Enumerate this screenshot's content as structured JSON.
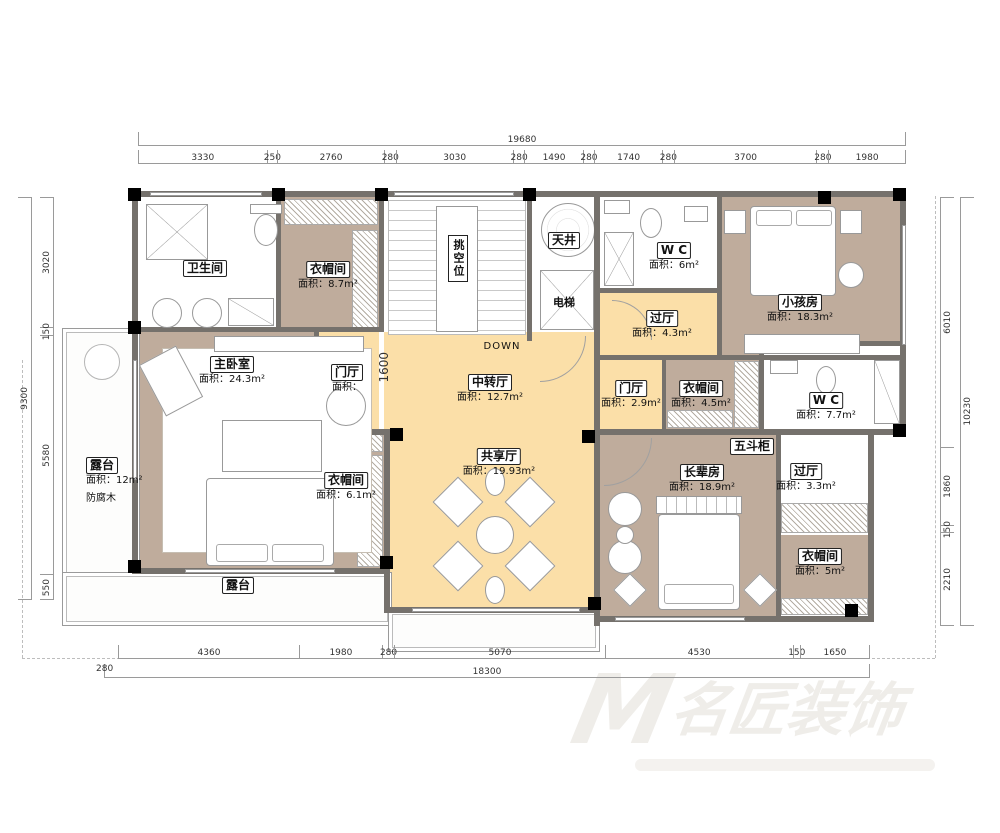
{
  "watermark": {
    "logo": "M",
    "text": "名匠装饰"
  },
  "colors": {
    "hall": "#FBDFA8",
    "room_taupe": "#BFAC9C",
    "wall": "#75716C",
    "column": "#000000"
  },
  "dimensions": {
    "top": {
      "total": "19680",
      "segments": [
        "3330",
        "250",
        "2760",
        "280",
        "3030",
        "280",
        "1490",
        "280",
        "1740",
        "280",
        "3700",
        "280",
        "1980"
      ]
    },
    "bottom": {
      "total": "18300",
      "lead": "280",
      "segments": [
        "4360",
        "1980",
        "280",
        "5070",
        "4530",
        "150",
        "1650"
      ]
    },
    "left": {
      "total": "9300",
      "segments": [
        "3020",
        "150",
        "5580",
        "550"
      ]
    },
    "right": {
      "total": "10230",
      "segments": [
        "6010",
        "1860",
        "150",
        "2210"
      ]
    }
  },
  "rooms": [
    {
      "name": "卫生间",
      "area": ""
    },
    {
      "name": "衣帽间",
      "area": "面积：8.7m²"
    },
    {
      "name": "W C",
      "area": "面积：6m²"
    },
    {
      "name": "过厅",
      "area": "面积：4.3m²"
    },
    {
      "name": "小孩房",
      "area": "面积：18.3m²"
    },
    {
      "name": "主卧室",
      "area": "面积：24.3m²"
    },
    {
      "name": "门厅",
      "area": "面积："
    },
    {
      "name": "中转厅",
      "area": "面积：12.7m²"
    },
    {
      "name": "门厅",
      "area": "面积：2.9m²"
    },
    {
      "name": "衣帽间",
      "area": "面积：4.5m²"
    },
    {
      "name": "W C",
      "area": "面积：7.7m²"
    },
    {
      "name": "露台",
      "area": "面积：12m²",
      "note": "防腐木"
    },
    {
      "name": "衣帽间",
      "area": "面积：6.1m²"
    },
    {
      "name": "共享厅",
      "area": "面积：19.93m²"
    },
    {
      "name": "长辈房",
      "area": "面积：18.9m²"
    },
    {
      "name": "过厅",
      "area": "面积：3.3m²"
    },
    {
      "name": "衣帽间",
      "area": "面积：5m²"
    },
    {
      "name": "露台",
      "area": ""
    }
  ],
  "features": {
    "skywell": "天井",
    "elevator": "电梯",
    "void": "挑空位",
    "down": "DOWN",
    "chest": "五斗柜",
    "stair_dim": "1600"
  }
}
